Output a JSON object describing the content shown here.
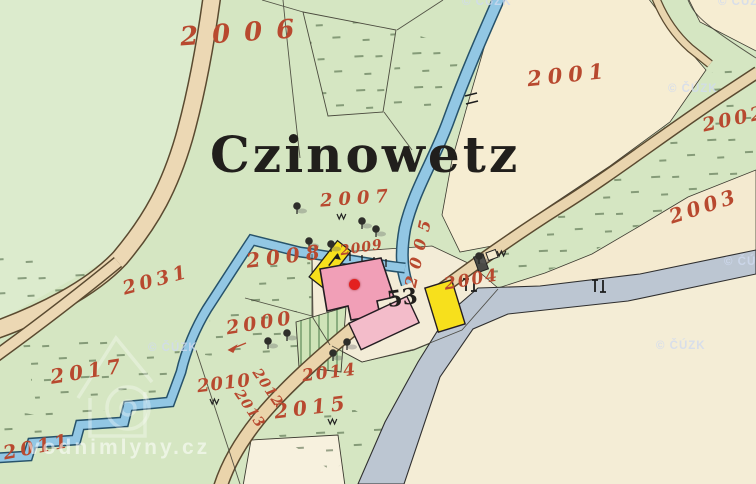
{
  "map": {
    "place_label": "Czinowetz",
    "house_number": "53",
    "parcels": {
      "n2000": "2000",
      "n2001": "2001",
      "n2002": "2002",
      "n2003": "2003",
      "n2004": "2004",
      "n2005": "2005",
      "n2006": "2006",
      "n2007": "2007",
      "n2008": "2008",
      "n2009": "2009",
      "n2010": "2010",
      "n2011": "2011",
      "n2012": "2012",
      "n2013": "2013",
      "n2014": "2014",
      "n2015": "2015",
      "n2017": "2017",
      "n2031": "2031"
    },
    "watermarks": {
      "copyright": "© ČÚZK",
      "site": "vodnimlyny.cz"
    },
    "colors": {
      "parcel_number_red": "#b8492f",
      "field_green": "#d5e6c2",
      "field_cream": "#f4ead0",
      "stream_blue": "#92c7e4",
      "road_tan": "#ead4ab",
      "road_gray": "#bcc6d2",
      "building_pink": "#f19fb7",
      "building_yellow": "#f7e01c",
      "marker_red": "#e32020"
    }
  }
}
